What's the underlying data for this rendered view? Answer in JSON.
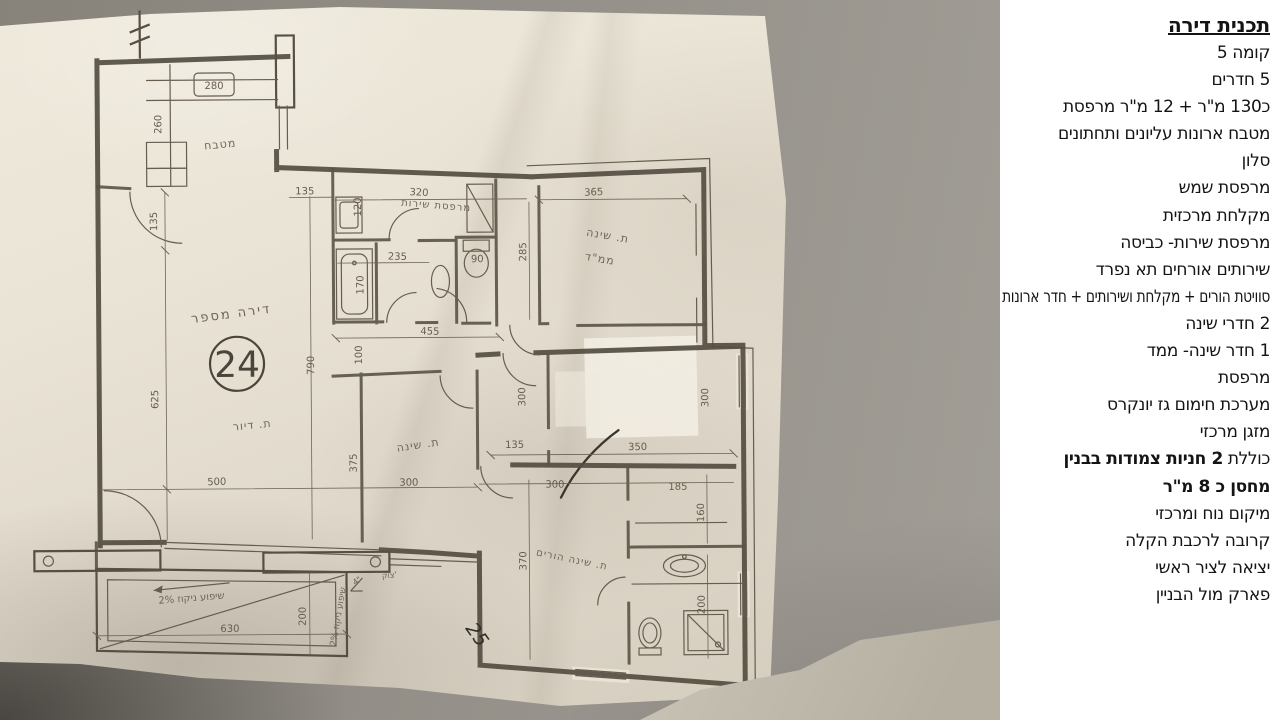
{
  "listing": {
    "title": "תכנית דירה",
    "lines": [
      {
        "text": "קומה 5"
      },
      {
        "text": "5 חדרים"
      },
      {
        "text": "כ130 מ\"ר + 12 מ\"ר מרפסת"
      },
      {
        "text": "מטבח ארונות עליונים ותחתונים"
      },
      {
        "text": "סלון"
      },
      {
        "text": "מרפסת שמש"
      },
      {
        "text": "מקלחת מרכזית"
      },
      {
        "text": "מרפסת שירות- כביסה"
      },
      {
        "text": "שירותים אורחים תא נפרד"
      },
      {
        "text": "סוויטת הורים + מקלחת ושירותים + חדר ארונות"
      },
      {
        "text": "2 חדרי שינה"
      },
      {
        "text": "1 חדר שינה- ממד"
      },
      {
        "text": "מרפסת"
      },
      {
        "text": "מערכת חימום גז יונקרס"
      },
      {
        "text": "מזגן מרכזי"
      },
      {
        "prefix": "כוללת ",
        "bold": "2 חניות צמודות בבנין"
      },
      {
        "text": "מחסן כ 8 מ\"ר",
        "bold_all": true
      },
      {
        "text": "מיקום נוח ומרכזי"
      },
      {
        "text": "קרובה לרכבת הקלה"
      },
      {
        "text": "יציאה לציר ראשי"
      },
      {
        "text": "פארק מול הבניין"
      }
    ]
  },
  "plan": {
    "apartment_label": "דירה מספר",
    "apartment_number": "24",
    "rooms": {
      "kitchen": "מטבח",
      "living": "ת. דיור",
      "service_balcony": "מרפסת שירות",
      "mamad_line1": "ת. שינה",
      "mamad_line2": "ממ\"ד",
      "bedroom": "ת. שינה",
      "parents_bedroom": "ת. שינה הורים"
    },
    "dimensions": {
      "kitchen_counter": "280",
      "kitchen_depth": "260",
      "kitchen_door": "135",
      "passage": "135",
      "service_width": "320",
      "service_side": "120",
      "bath_width": "235",
      "bathtub": "170",
      "wc": "90",
      "hall_width": "455",
      "hall_depth": "100",
      "mamad_width": "365",
      "mamad_depth": "285",
      "living_length": "790",
      "living_side": "625",
      "living_width": "500",
      "bedroom_depth": "375",
      "bedroom_width": "300",
      "corridor": "135",
      "room_width": "350",
      "room_depth_a": "300",
      "room_depth_b": "300",
      "segment_a": "300",
      "segment_b": "185",
      "parents_depth": "370",
      "closet": "160",
      "bathroom": "200",
      "balcony_width": "630",
      "balcony_depth": "200"
    },
    "annotations": {
      "slope_1": "שיפוע ניקוז 2%",
      "slope_2": "שיפוע ניקוז 2%",
      "slope_angle": "4\"",
      "curb": "צוק'",
      "handwritten_mark": "25"
    }
  }
}
